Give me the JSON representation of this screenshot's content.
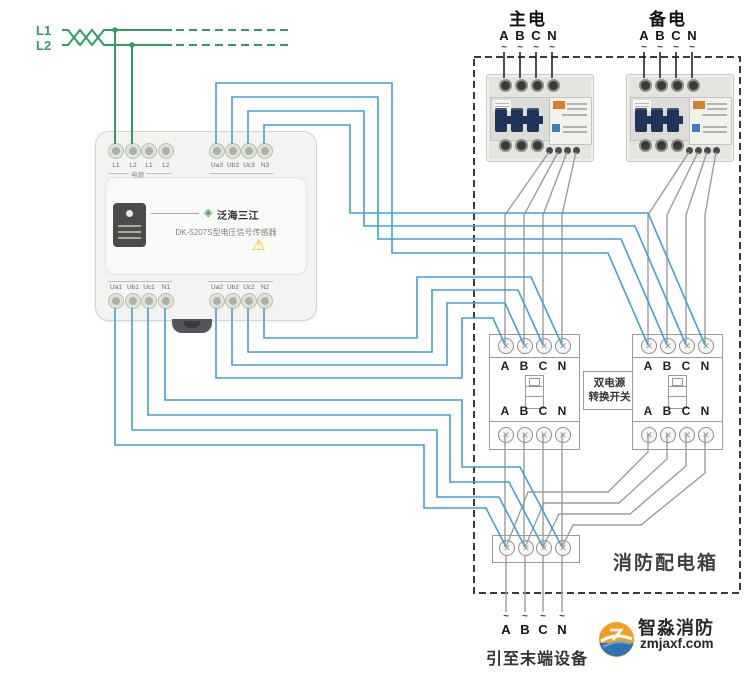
{
  "incoming": {
    "lines": [
      "L1",
      "L2"
    ]
  },
  "sensor": {
    "brand": "泛海三江",
    "brand_mark": "◈",
    "model": "DK-5207S型电压信号传感器",
    "warning_icon": "⚠",
    "top_left_terminals": [
      "L1",
      "L2",
      "L1",
      "L2"
    ],
    "top_left_group_label": "电源",
    "top_right_terminals": [
      "Ua3",
      "Ub3",
      "Uc3",
      "N3"
    ],
    "bottom_left_terminals": [
      "Ua1",
      "Ub1",
      "Uc1",
      "N1"
    ],
    "bottom_right_terminals": [
      "Ua2",
      "Ub2",
      "Uc2",
      "N2"
    ]
  },
  "panel": {
    "title": "消防配电箱",
    "main_supply_label": "主电",
    "backup_supply_label": "备电",
    "phases": [
      "A",
      "B",
      "C",
      "N"
    ],
    "tilde": "~",
    "screw_glyph": "✕",
    "transfer_switch_lines": [
      "双电源",
      "转换开关"
    ],
    "output_caption": "引至末端设备"
  },
  "watermark": {
    "title": "智淼消防",
    "domain": "zmjaxf.com"
  },
  "colors": {
    "wire_signal": "#3FA2D9",
    "wire_power_in": "#2F9E63",
    "wire_internal": "#9C9C9C",
    "wire_supply": "#222222",
    "warning": "#F2C400"
  }
}
